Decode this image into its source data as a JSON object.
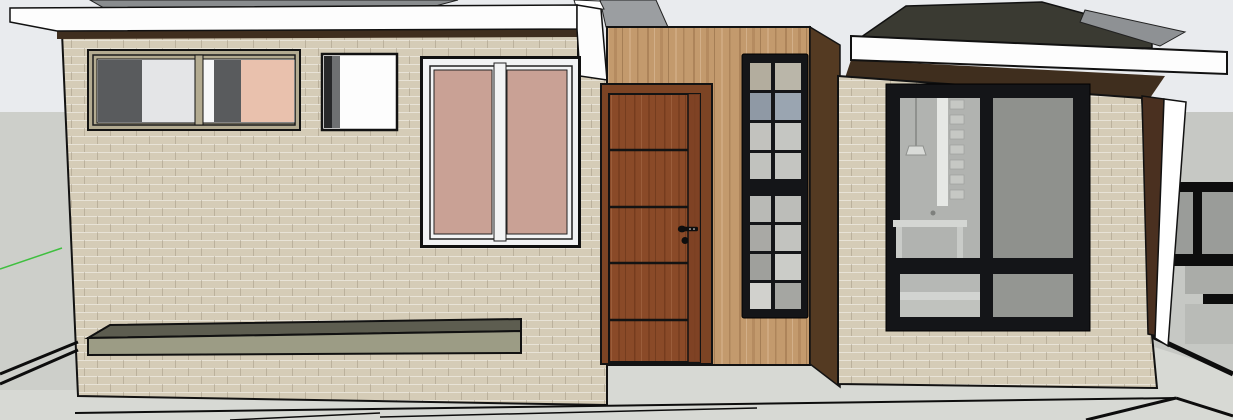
{
  "viewport": {
    "description": "3D modeling viewport showing the front elevation of a modern single-storey house",
    "axes_indicator": "green-drawing-axis"
  },
  "colors": {
    "sky": "#e9ebee",
    "bg_left": "#cdcfca",
    "bg_right": "#c6c8c4",
    "ground": "#d7d9d4",
    "fascia_white": "#fdfdfd",
    "soffit_brown": "#3f2e1e",
    "roof_gray": "#898c8e",
    "roof_corner_gray": "#9b9ea1",
    "roof_dark": "#3a3a32",
    "roof_wedge": "#8e9194",
    "brick_base": "#d5ccb7",
    "wood_base": "#c39a6d",
    "wood_dark_side": "#543a22",
    "door_wood": "#8a4a28",
    "door_stile": "#7c4123",
    "door_frame": "#7c4424",
    "line_black": "#121212",
    "window_khaki": "#b3ab91",
    "pane_dark": "#595b5d",
    "pane_light": "#e4e5e7",
    "pane_white": "#f6f7f8",
    "pane_peach": "#e9c1ad",
    "glass_pink": "#c9a195",
    "window_white": "#f2f3f4",
    "win_frame_black": "#141518",
    "glass_gray": "#8f918d",
    "glass_gray2": "#949692",
    "interior_bg": "#b1b3b0",
    "interior_bg2": "#b6b8b5",
    "interior_light": "#e6e8e5",
    "bench_top": "#5d5d50",
    "bench_front": "#9c9c85",
    "axis_green": "#3fbf3f",
    "gate_gray": "#9a9c99",
    "gate_gray2": "#aaaca8",
    "gate_light": "#b9bbb7"
  },
  "glass_grid": {
    "rows": [
      {
        "left": "#b3ad9e",
        "right": "#bab6a9"
      },
      {
        "left": "#8f99a5",
        "right": "#9aa5b1"
      },
      {
        "left": "#c2c2be",
        "right": "#c5c6c2"
      },
      {
        "left": "#c1c2be",
        "right": "#c4c5c1"
      },
      {
        "left": "#b9bab6",
        "right": "#bcbdb9"
      },
      {
        "left": "#a9a9a5",
        "right": "#c2c3bf"
      },
      {
        "left": "#9fa09c",
        "right": "#cbccc8"
      },
      {
        "left": "#d1d1cd",
        "right": "#a5a6a2"
      }
    ]
  },
  "model_elements": [
    "left-wing-hip-roof",
    "left-wing-fascia",
    "left-wing-wall",
    "strip-window",
    "small-window",
    "pink-sliding-window",
    "planter-bench",
    "entry-recess-wood-wall",
    "entry-door",
    "door-handle",
    "sidelight-grid-window",
    "right-wing-hip-roof",
    "right-wing-fascia",
    "right-wing-wall",
    "large-black-frame-window",
    "background-gate",
    "ground-plane"
  ]
}
